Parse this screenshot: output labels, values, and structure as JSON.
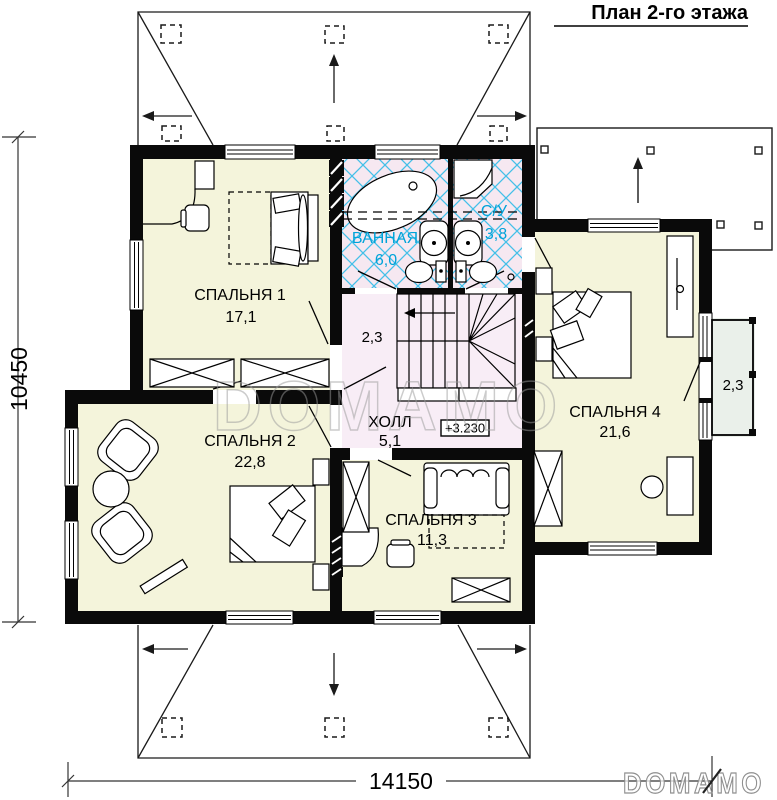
{
  "title": "План 2-го этажа",
  "rooms": {
    "bedroom1": {
      "name": "СПАЛЬНЯ 1",
      "area": "17,1"
    },
    "bathroom": {
      "name": "ВАННАЯ",
      "area": "6,0"
    },
    "wc": {
      "name": "С/У",
      "area": "3,8"
    },
    "stair_landing": {
      "area": "2,3"
    },
    "hall": {
      "name": "ХОЛЛ",
      "area": "5,1"
    },
    "bedroom2": {
      "name": "СПАЛЬНЯ 2",
      "area": "22,8"
    },
    "bedroom3": {
      "name": "СПАЛЬНЯ 3",
      "area": "11,3"
    },
    "bedroom4": {
      "name": "СПАЛЬНЯ 4",
      "area": "21,6"
    },
    "balcony": {
      "area": "2,3"
    }
  },
  "level_mark": "+3.230",
  "dimensions": {
    "height": "10450",
    "width": "14150"
  },
  "watermark": {
    "center": "DOMAMO",
    "corner": "DOMAMO"
  },
  "colors": {
    "wall": "#0a0a0a",
    "room_fill": "#f4f4db",
    "wet_fill": "#f6e8f1",
    "hall_fill": "#f8edf6",
    "balcony_fill": "#eaf0ea",
    "lattice": "#44c0e8",
    "wet_text": "#00a3d9",
    "watermark": "#9a9a9a"
  }
}
